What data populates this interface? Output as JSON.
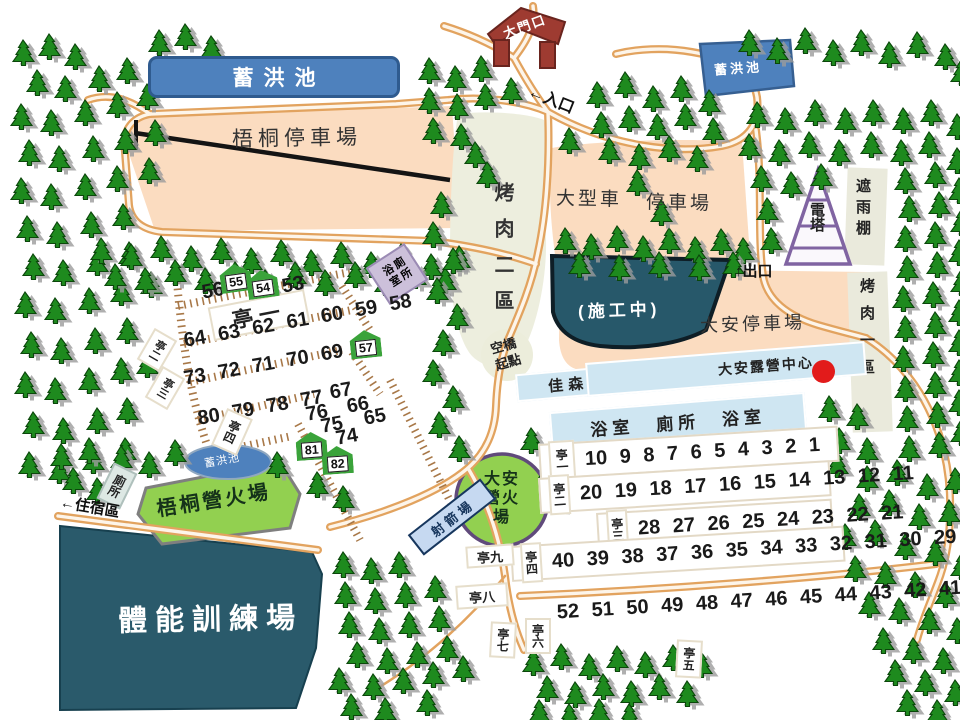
{
  "areas": {
    "pond_label_tl": "蓄洪池",
    "pond_label_tr": "蓄洪池",
    "pond_label_ellipse": "蓄洪池",
    "wutong_parking": "梧桐停車場",
    "gate": "大門口",
    "entrance_note": "←入口",
    "exit_note": "↑出口",
    "lodging_note": "←住宿區",
    "lvp_left": "大型車",
    "lvp_right": "停車場",
    "bbq2": "烤肉二區",
    "bbq1": "烤肉一區",
    "rain_shelter": "遮雨棚",
    "power_tower": "電塔",
    "daan_parking": "大安停車場",
    "construction": "(施工中)",
    "bath_toilet_box": "浴室廁所",
    "skybridge": "空橋起點",
    "restaurant": "佳森餐廳",
    "camp_center": "大安露營中心",
    "bath_bar": "浴室　廁所　浴室",
    "wutong_campfire": "梧桐營火場",
    "daan_campfire": "大安營火場",
    "archery": "射箭場",
    "training": "體能訓練場",
    "toilet_small": "廁所"
  },
  "left_sites": {
    "pav1": "亭一",
    "pav2": "亭二",
    "pav3": "亭三",
    "pav4": "亭四",
    "n56": "56",
    "n53": "53",
    "row64": "64 63 62 61 60 59 58",
    "row73": "73 72 71 70 69 68",
    "n67": "67",
    "n66": "66",
    "n65": "65",
    "row80": "80 79 78 77",
    "n76": "76",
    "n75": "75",
    "n74": "74",
    "h55": "55",
    "h54": "54",
    "h57": "57",
    "h81": "81",
    "h82": "82"
  },
  "right_sites": {
    "rows": [
      {
        "label": "亭一",
        "numbers": "10 9 8 7 6 5 4 3 2 1"
      },
      {
        "label": "亭二",
        "numbers": "20 19 18 17 16 15 14 13 12 11"
      },
      {
        "label": "亭三",
        "numbers": "28 27 26 25 24 23 22 21"
      },
      {
        "label": "亭四",
        "numbers": "40 39 38 37 36 35 34 33 32 31 30 29"
      },
      {
        "label": "",
        "numbers": "52 51 50 49 48 47 46 45 44 43 42 41"
      }
    ],
    "pav9": "亭九",
    "pav8": "亭八",
    "pav7": "亭七",
    "pav6": "亭六",
    "pav5": "亭五"
  },
  "colors": {
    "road": "#E2A35F",
    "parking": "#FBDCC0",
    "pond": "#4E81BD",
    "dark_area": "#2A5A6B",
    "lawn": "#92D050",
    "tree": "#1E8A1E",
    "bar_blue": "#CFE6F2",
    "box_purple": "#CCC0DA",
    "marker_red": "#E21B1B"
  }
}
